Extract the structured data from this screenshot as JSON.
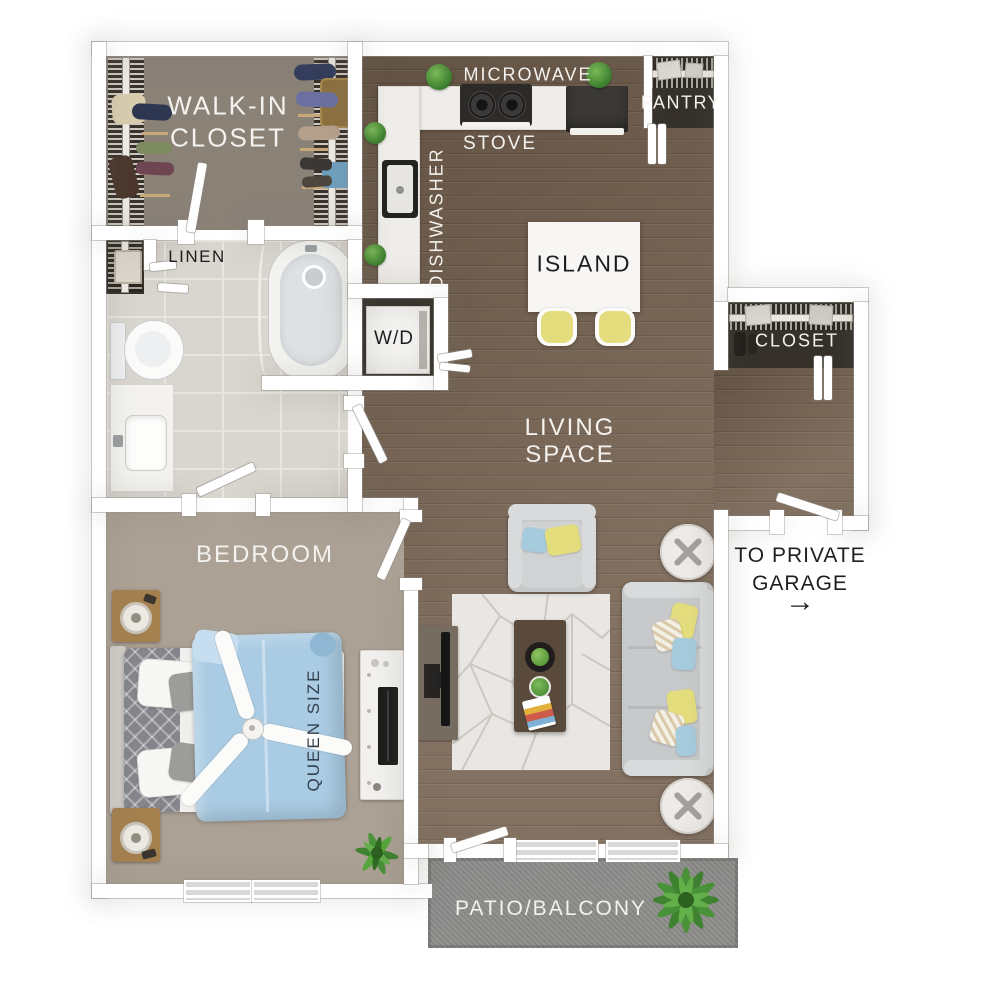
{
  "labels": {
    "walk_in_closet": {
      "line1": "WALK-IN",
      "line2": "CLOSET"
    },
    "linen": "LINEN",
    "microwave": "MICROWAVE",
    "stove": "STOVE",
    "dishwasher": "DISHWASHER",
    "pantry": "PANTRY",
    "island": "ISLAND",
    "washer_dryer": "W/D",
    "closet": "CLOSET",
    "living_space": {
      "line1": "LIVING",
      "line2": "SPACE"
    },
    "bedroom": "BEDROOM",
    "queen_size": "QUEEN SIZE",
    "patio_balcony": "PATIO/BALCONY",
    "garage": {
      "line1": "TO PRIVATE",
      "line2": "GARAGE"
    }
  },
  "icons": {
    "garage_arrow": "→"
  },
  "colors": {
    "wall": "#ffffff",
    "wood": "#75614f",
    "closet_floor": "#8a8177",
    "bedroom_floor": "#aca195",
    "tile": "#d9d5cf",
    "grout": "#e8e5e0",
    "patio": "#8d8d8c",
    "dark_interior": "#35302a",
    "duvet_blue": "#a9cbe3",
    "accent_yellow": "#e3dd7d",
    "accent_blue": "#a6cbdd",
    "sofa_gray": "#c7c9ca",
    "sofa_light": "#d8dadb",
    "rug": "#e9e7e3",
    "table_wood": "#5a4a3b",
    "nightstand_wood": "#a5804f",
    "plant_green": "#4a9238",
    "label_light": "#f4f2ee",
    "label_dark": "#1e1e1e",
    "queen_text": "#33404c"
  }
}
